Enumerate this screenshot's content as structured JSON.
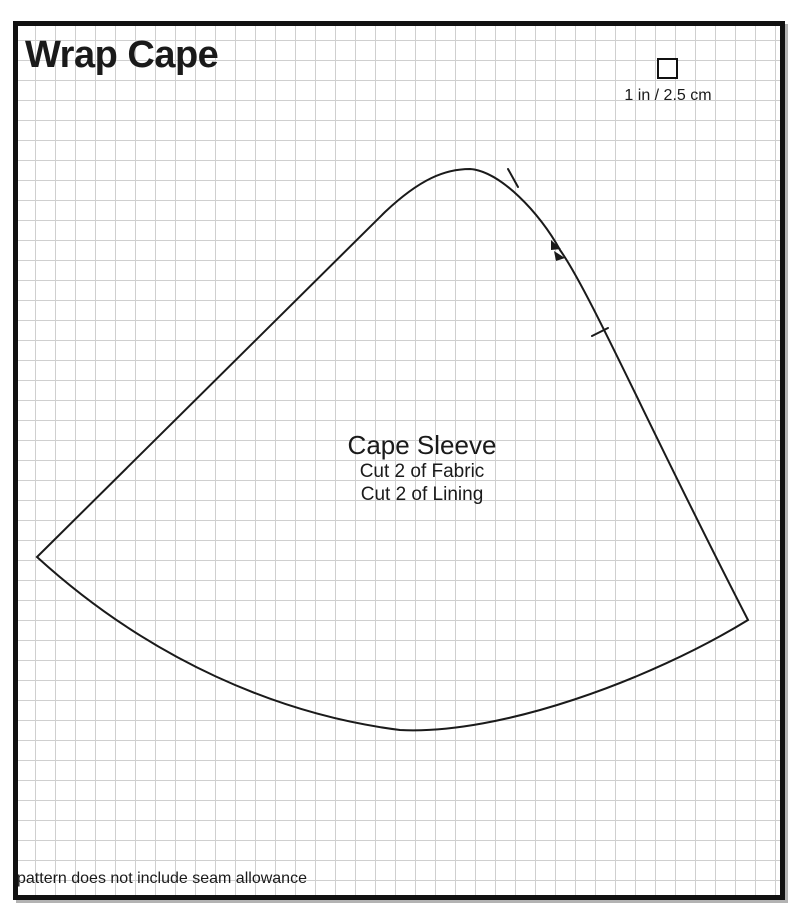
{
  "sheet": {
    "title": "Wrap Cape",
    "scale": {
      "label": "1 in / 2.5 cm",
      "icon": "square-outline"
    },
    "piece": {
      "name": "Cape Sleeve",
      "cut_fabric": "Cut 2 of Fabric",
      "cut_lining": "Cut 2 of Lining"
    },
    "footnote": "pattern does not include seam allowance",
    "icons": {
      "notch_single": "tick-mark",
      "notch_double": "double-triangle"
    },
    "colors": {
      "outline": "#1a1a1a",
      "grid_line": "#cfcfcf",
      "border": "#111111",
      "paper": "#ffffff",
      "shadow": "#b3b3b3"
    }
  }
}
